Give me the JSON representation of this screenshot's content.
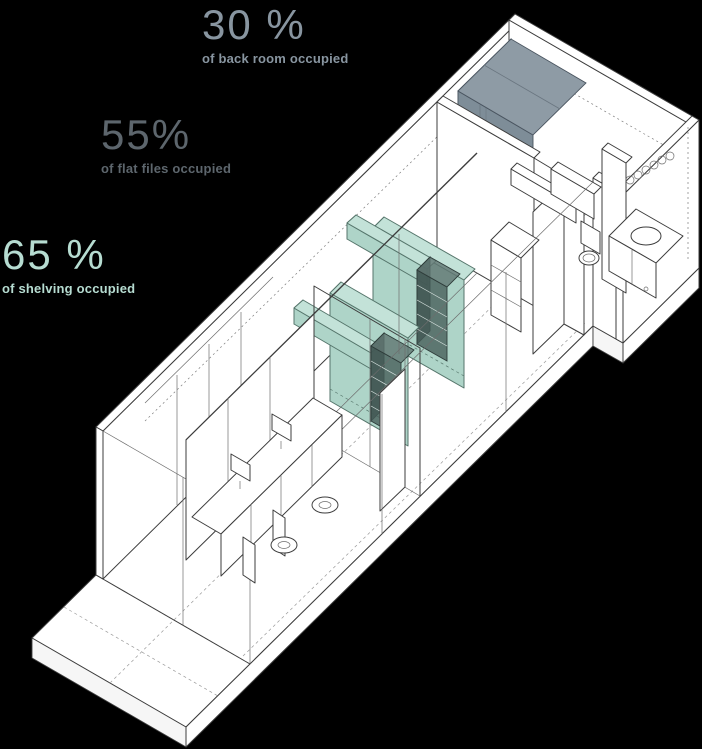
{
  "page": {
    "width": 702,
    "height": 749,
    "background": "#000000"
  },
  "stats": [
    {
      "id": "back-room",
      "value": "30 %",
      "caption": "of back room occupied",
      "color": "#8895a0"
    },
    {
      "id": "flat-files",
      "value": "55%",
      "caption": "of flat files occupied",
      "color": "#5d666d"
    },
    {
      "id": "shelving",
      "value": "65 %",
      "caption": "of shelving occupied",
      "color": "#b6dcd1"
    }
  ],
  "diagram": {
    "description": "axonometric line drawing of a long narrow space: front office with desks, middle room with highlighted shelving and flat files, back room with occupied-storage volume, bathroom annex at right",
    "colors": {
      "line": "#3d3d3d",
      "paper": "#ffffff",
      "gray_edge": "#4a5560",
      "teal_edge": "#55756b",
      "back_room_top": "#8e9ba5",
      "back_room_front": "#7e8d98",
      "back_room_side": "#97a4ad",
      "shelving_front": "#aed4c8",
      "shelving_top": "#c3e2d8",
      "shelving_side": "#9cc7ba",
      "flat_file_front": "rgba(70,92,88,0.78)",
      "flat_file_top": "rgba(96,118,114,0.80)",
      "flat_file_side": "rgba(58,78,74,0.85)"
    }
  }
}
